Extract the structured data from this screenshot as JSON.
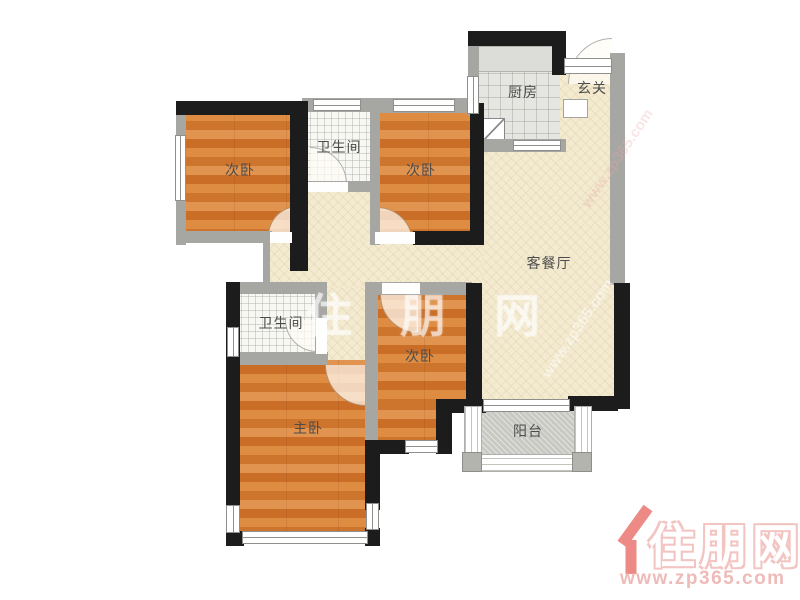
{
  "floor_plan": {
    "rooms": [
      {
        "id": "bedroom-top-left",
        "label": "次卧"
      },
      {
        "id": "bathroom-top",
        "label": "卫生间"
      },
      {
        "id": "bedroom-top-right",
        "label": "次卧"
      },
      {
        "id": "kitchen",
        "label": "厨房"
      },
      {
        "id": "entry",
        "label": "玄关"
      },
      {
        "id": "living-dining",
        "label": "客餐厅"
      },
      {
        "id": "bathroom-middle",
        "label": "卫生间"
      },
      {
        "id": "bedroom-right",
        "label": "次卧"
      },
      {
        "id": "master-bedroom",
        "label": "主卧"
      },
      {
        "id": "balcony",
        "label": "阳台"
      }
    ],
    "colors": {
      "wood_floor": "#d27c35",
      "living_floor": "#f3ead0",
      "tile_floor": "#f7f7f4",
      "kitchen_floor": "#e5e5e1",
      "balcony_floor": "#c9c9c4",
      "wall_black": "#1c1c1c",
      "wall_gray": "#a6a6a3"
    }
  },
  "watermarks": {
    "center_text": "住朋网",
    "diagonal_text_1": "www.zp365.com",
    "diagonal_text_2": "www.zp365.com"
  },
  "logo": {
    "site_name": "住朋网",
    "site_url": "www.zp365.com",
    "brand_color": "#ed8a86"
  }
}
